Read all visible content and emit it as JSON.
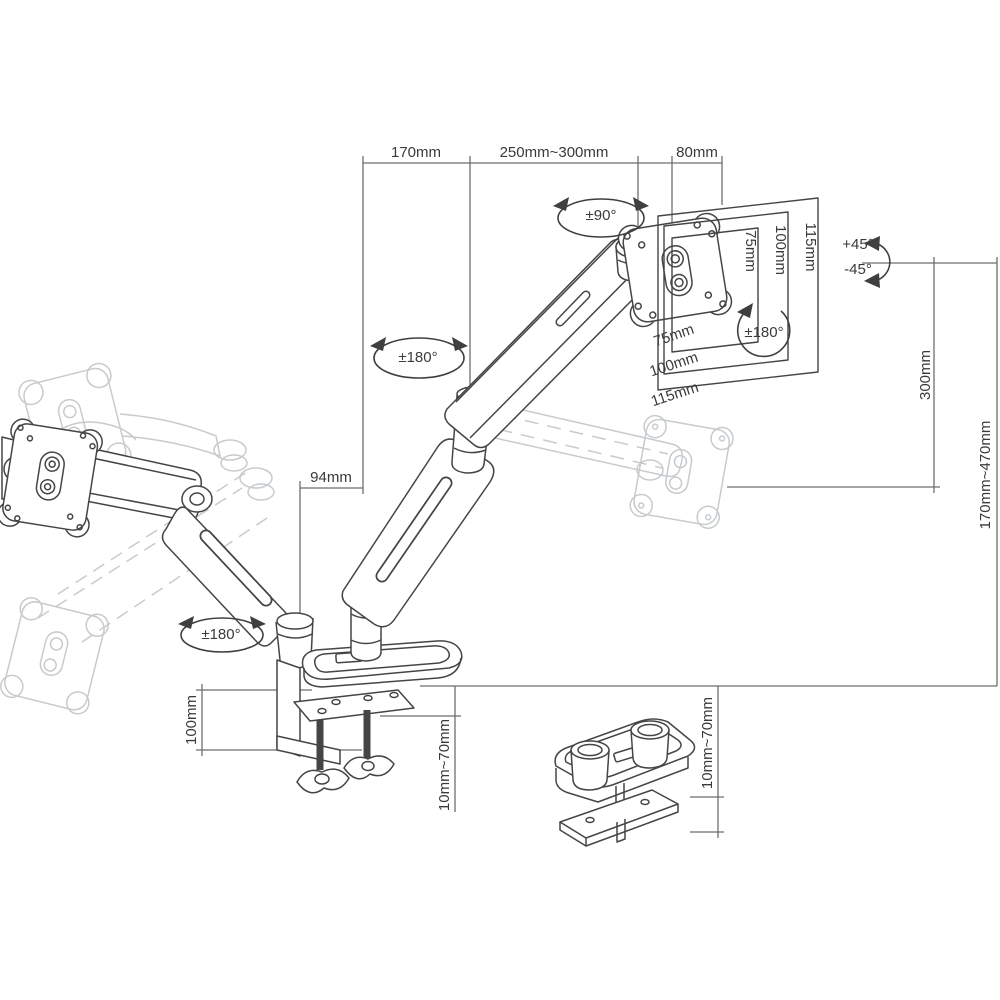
{
  "figure": {
    "type": "technical-dimension-diagram",
    "product": "gas-spring monitor desk mount arm with clamp and grommet base",
    "line_color": "#3f3f3f",
    "ghost_color": "#c7cbce",
    "dimension_line_color": "#6e6e6e",
    "labels": {
      "top_width_rear": "170mm",
      "top_width_front": "250mm~300mm",
      "top_width_head": "80mm",
      "head_swivel": "±90°",
      "vesa_right_75": "75mm",
      "vesa_right_100": "100mm",
      "vesa_right_115": "115mm",
      "tilt_up": "+45°",
      "tilt_down": "-45°",
      "vesa_rotation": "±180°",
      "vesa_bottom_75": "75mm",
      "vesa_bottom_100": "100mm",
      "vesa_bottom_115": "115mm",
      "lift_range": "300mm",
      "height_range": "170mm~470mm",
      "elbow_swivel": "±180°",
      "pole_offset": "94mm",
      "base_swivel": "±180°",
      "clamp_height": "100mm",
      "clamp_thickness_range": "10mm~70mm",
      "grommet_thickness_range": "10mm~70mm"
    }
  }
}
